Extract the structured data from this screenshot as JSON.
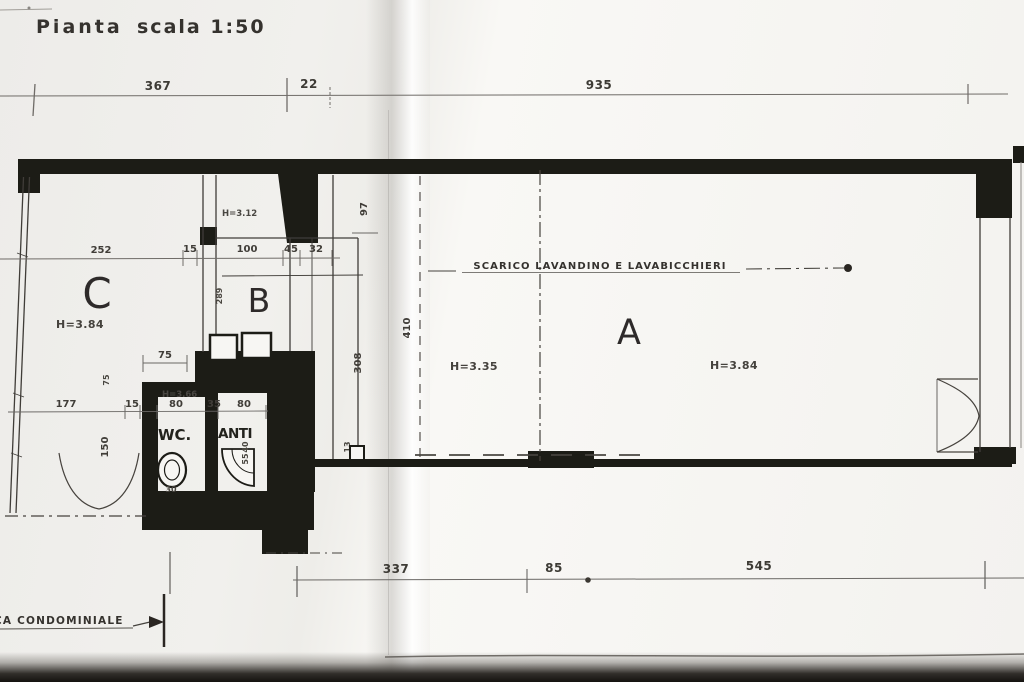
{
  "page": {
    "title": "Pianta",
    "scale": "scala 1:50"
  },
  "rooms": {
    "a": "A",
    "b": "B",
    "c": "C",
    "wc": "WC.",
    "anti": "ANTI"
  },
  "heights": {
    "room_c": "H=3.84",
    "shaft": "H=3.12",
    "room_wc": "H=3.66",
    "room_a_left": "H=3.35",
    "room_a_right": "H=3.84"
  },
  "annotations": {
    "drain_note": "SCARICO LAVANDINO E LAVABICCHIERI",
    "condominium_note": "CA CONDOMINIALE"
  },
  "dimensions": {
    "top": [
      "367",
      "22",
      "935"
    ],
    "upper_interior": [
      "252",
      "15",
      "100",
      "45",
      "32"
    ],
    "bottom": [
      "337",
      "85",
      "545"
    ],
    "wc_line": [
      "177",
      "15",
      "80",
      "35",
      "80"
    ],
    "vertical": {
      "shaft_right": "97",
      "room_b": "289",
      "corridor": "308",
      "room_a": "410",
      "sill": "13"
    },
    "small": {
      "top_75": "75",
      "side_75": "75",
      "side_150": "150",
      "toilet_30": "30",
      "sink_40": "40",
      "sink_55": "55"
    }
  },
  "colors": {
    "paper": "#f4f2ef",
    "ink": "#3a3733",
    "wall": "#1d1b18",
    "shadow": "#14120f"
  }
}
